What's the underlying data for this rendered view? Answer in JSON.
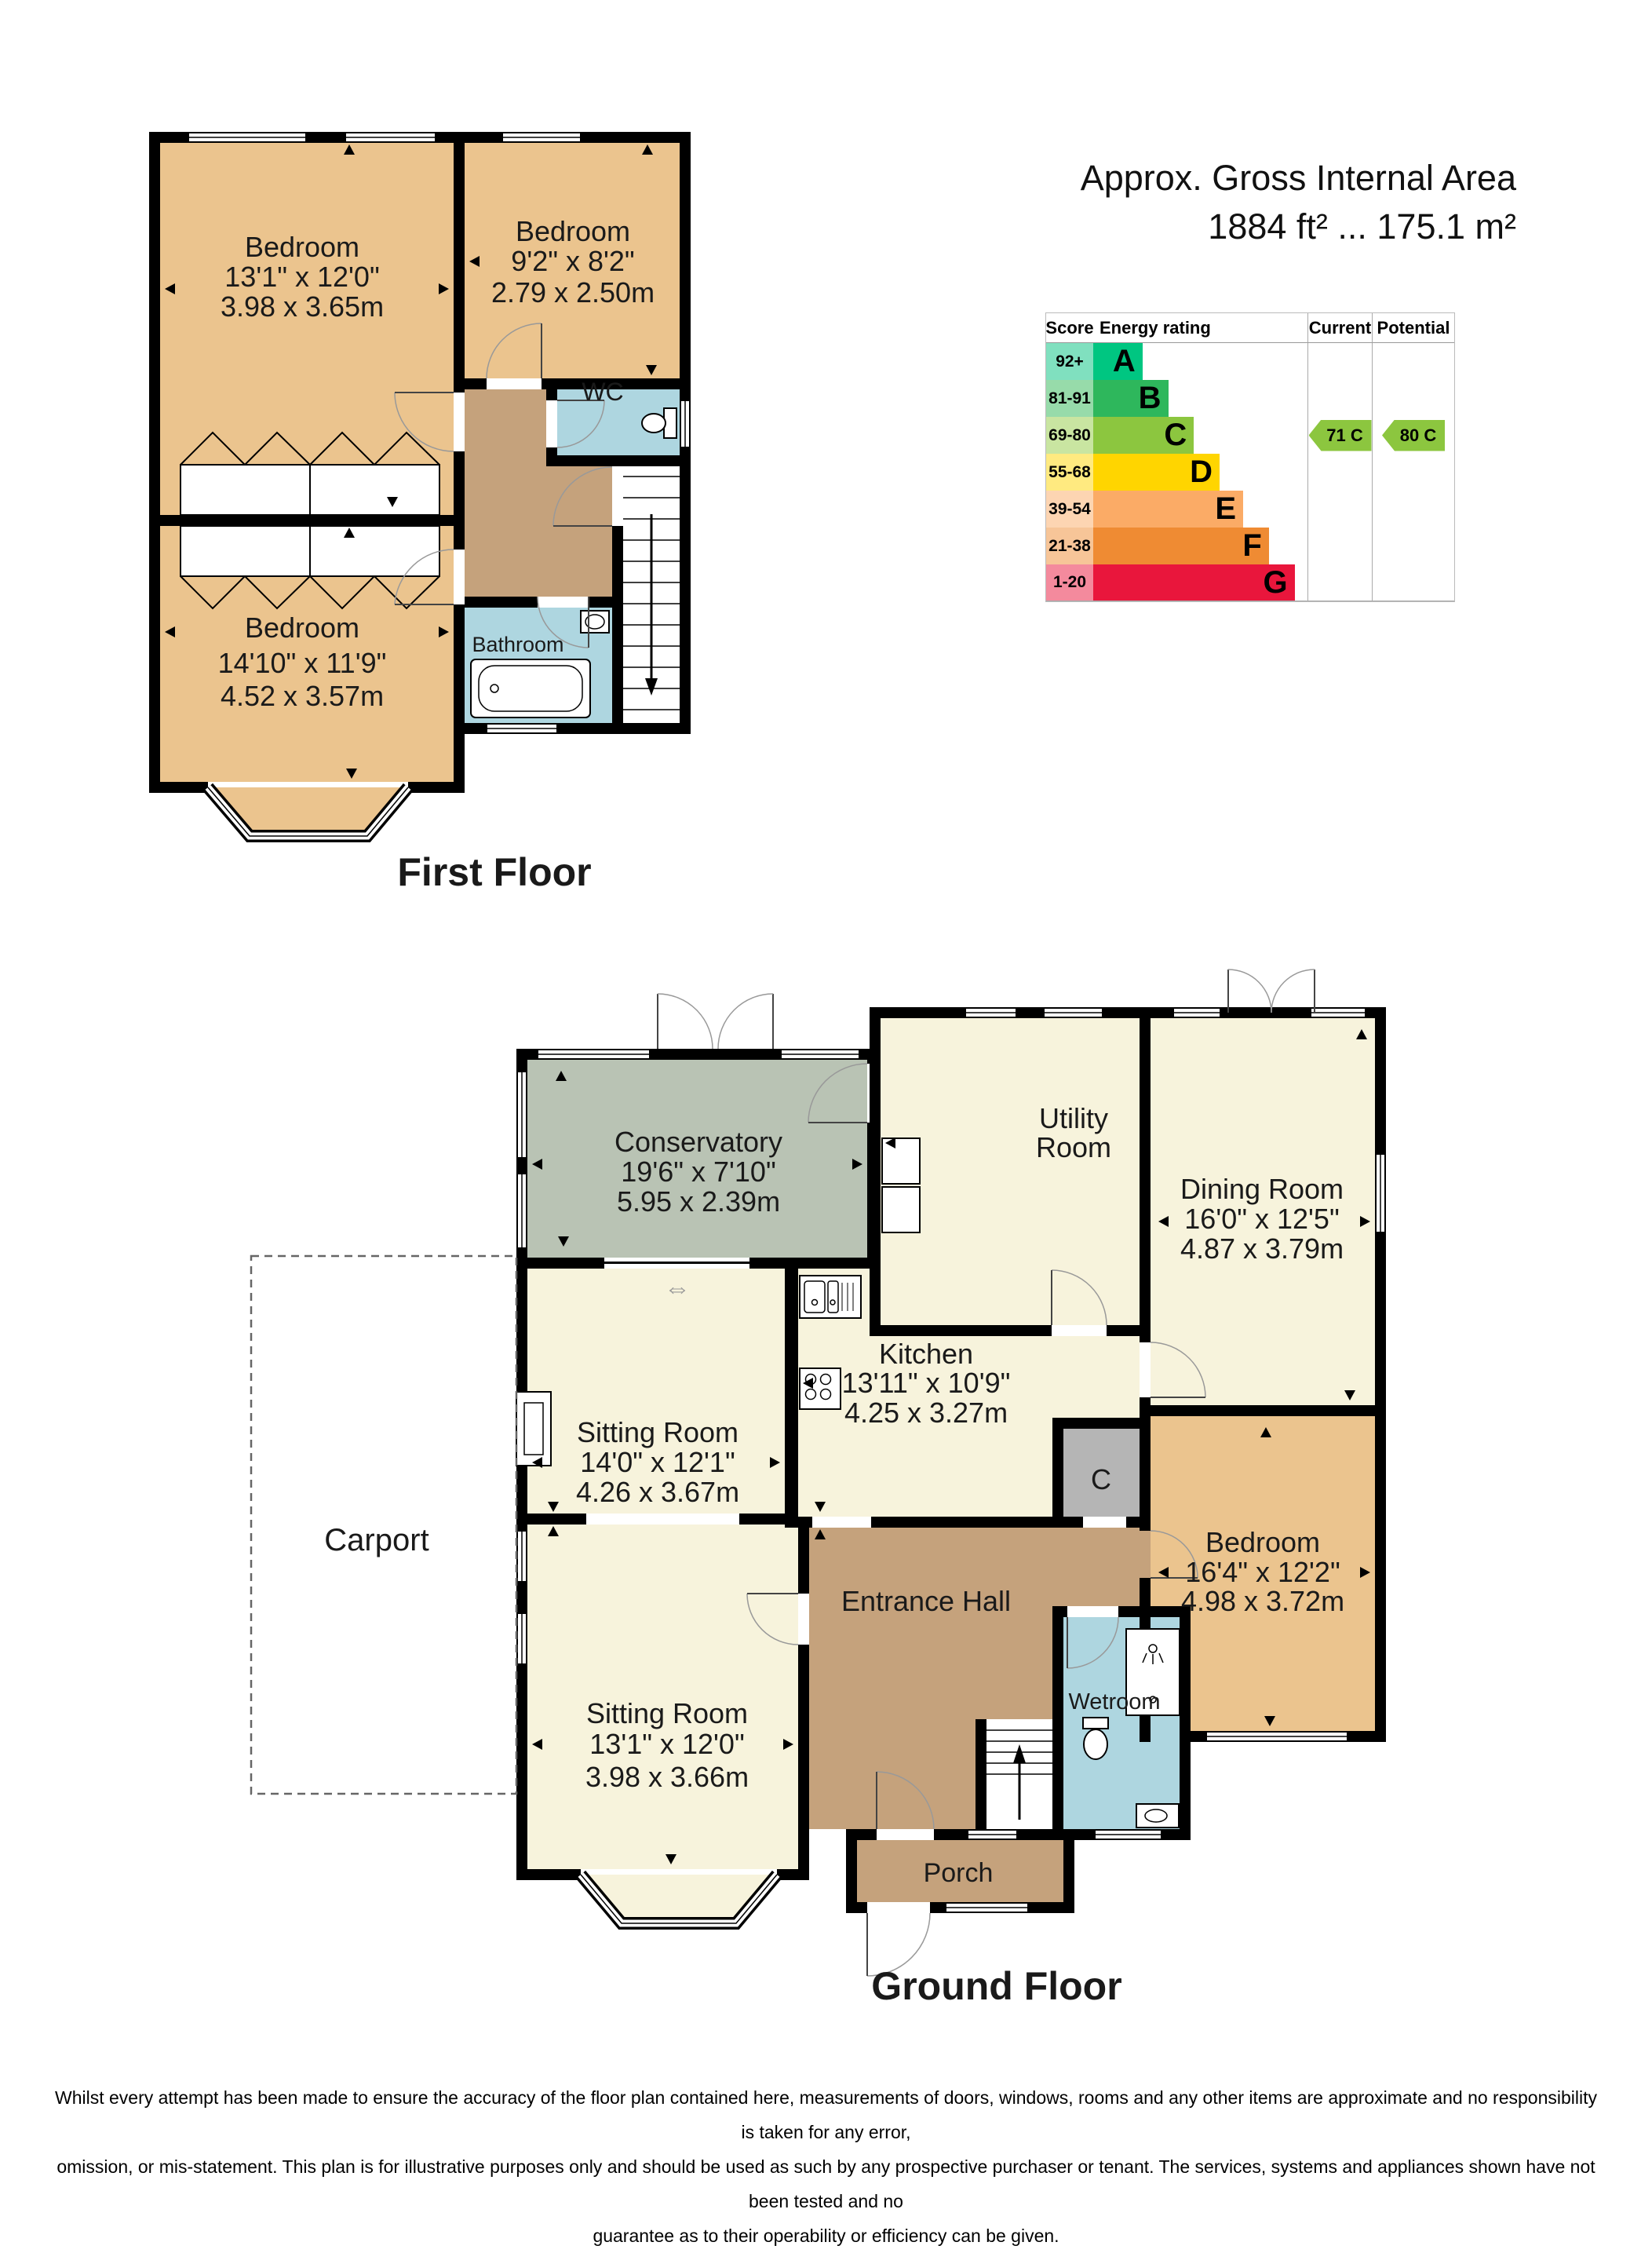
{
  "palette": {
    "bedroom_tan": "#ebc48e",
    "living_cream": "#f7f3dc",
    "hall_brown": "#c5a27c",
    "wet_blue": "#aed6e0",
    "conservatory_green": "#b9c3b4",
    "cupboard_gray": "#b5b5b5",
    "wall_black": "#000000"
  },
  "header": {
    "area_title": "Approx. Gross Internal Area",
    "area_value": "1884 ft² ... 175.1 m²"
  },
  "epc": {
    "headers": {
      "score": "Score",
      "rating": "Energy rating",
      "current": "Current",
      "potential": "Potential"
    },
    "bands": [
      {
        "score": "92+",
        "letter": "A",
        "bar_color": "#00c681",
        "score_color": "#80e0bf",
        "width_pct": 23
      },
      {
        "score": "81-91",
        "letter": "B",
        "bar_color": "#2eb75c",
        "score_color": "#97dbaa",
        "width_pct": 35
      },
      {
        "score": "69-80",
        "letter": "C",
        "bar_color": "#8cc63f",
        "score_color": "#c9e5a1",
        "width_pct": 47
      },
      {
        "score": "55-68",
        "letter": "D",
        "bar_color": "#ffd500",
        "score_color": "#ffea80",
        "width_pct": 59
      },
      {
        "score": "39-54",
        "letter": "E",
        "bar_color": "#fbab66",
        "score_color": "#fdd5b2",
        "width_pct": 70
      },
      {
        "score": "21-38",
        "letter": "F",
        "bar_color": "#ef8b33",
        "score_color": "#f7c598",
        "width_pct": 82
      },
      {
        "score": "1-20",
        "letter": "G",
        "bar_color": "#e9163c",
        "score_color": "#f48a9d",
        "width_pct": 94
      }
    ],
    "current": {
      "label": "71 C",
      "color": "#8cc63f"
    },
    "potential": {
      "label": "80 C",
      "color": "#8cc63f"
    }
  },
  "first_floor": {
    "title": "First Floor",
    "rooms": {
      "bedroom1": {
        "name": "Bedroom",
        "imperial": "13'1\" x 12'0\"",
        "metric": "3.98 x 3.65m"
      },
      "bedroom2": {
        "name": "Bedroom",
        "imperial": "9'2\" x 8'2\"",
        "metric": "2.79 x 2.50m"
      },
      "bedroom3": {
        "name": "Bedroom",
        "imperial": "14'10\" x 11'9\"",
        "metric": "4.52 x 3.57m"
      },
      "wc": {
        "name": "WC"
      },
      "bathroom": {
        "name": "Bathroom"
      }
    }
  },
  "ground_floor": {
    "title": "Ground Floor",
    "rooms": {
      "conservatory": {
        "name": "Conservatory",
        "imperial": "19'6\" x 7'10\"",
        "metric": "5.95 x 2.39m"
      },
      "utility": {
        "line1": "Utility",
        "line2": "Room"
      },
      "dining": {
        "name": "Dining Room",
        "imperial": "16'0\" x 12'5\"",
        "metric": "4.87 x 3.79m"
      },
      "kitchen": {
        "name": "Kitchen",
        "imperial": "13'11\" x 10'9\"",
        "metric": "4.25 x 3.27m"
      },
      "sitting1": {
        "name": "Sitting Room",
        "imperial": "14'0\" x 12'1\"",
        "metric": "4.26 x 3.67m"
      },
      "sitting2": {
        "name": "Sitting Room",
        "imperial": "13'1\" x 12'0\"",
        "metric": "3.98 x 3.66m"
      },
      "bedroom": {
        "name": "Bedroom",
        "imperial": "16'4\" x 12'2\"",
        "metric": "4.98 x 3.72m"
      },
      "entrance": {
        "name": "Entrance Hall"
      },
      "wetroom": {
        "name": "Wetroom"
      },
      "cupboard": {
        "name": "C"
      },
      "porch": {
        "name": "Porch"
      },
      "carport": {
        "name": "Carport"
      }
    },
    "slider_symbol": "⇔"
  },
  "disclaimer": {
    "line1": "Whilst every attempt has been made to ensure the accuracy of the floor plan contained here, measurements of doors, windows, rooms and any other items are approximate and no responsibility is taken for any error,",
    "line2": "omission, or mis-statement. This plan is for illustrative purposes only and should be used as such by any prospective purchaser or tenant. The services, systems and appliances shown have not been tested and no",
    "line3": "guarantee as to their operability or efficiency can be given."
  }
}
